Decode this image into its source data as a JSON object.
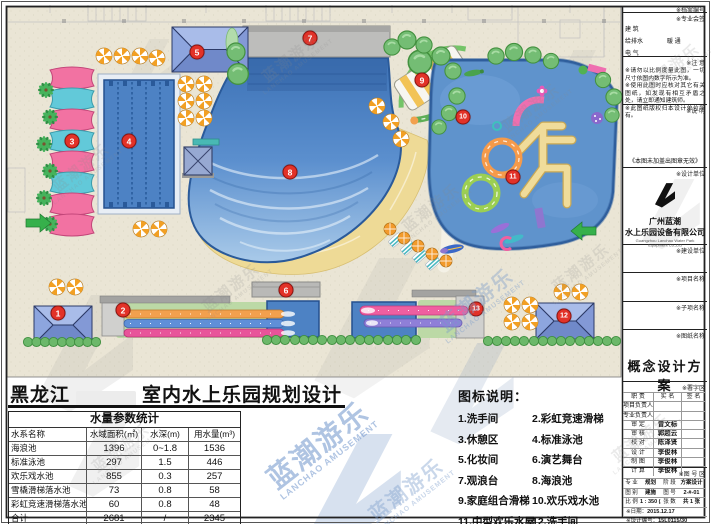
{
  "sheet": {
    "region": "黑龙江",
    "title": "室内水上乐园规划设计"
  },
  "watermark": {
    "cn": "蓝潮游乐",
    "en": "LANCHAO AMUSEMENT"
  },
  "plan": {
    "markers": [
      "1",
      "2",
      "3",
      "4",
      "5",
      "6",
      "7",
      "8",
      "9",
      "10",
      "11",
      "12",
      "13"
    ]
  },
  "water_table": {
    "title": "水量参数统计",
    "headers": [
      "水系名称",
      "水域面积(㎡)",
      "水深(m)",
      "用水量(m³)"
    ],
    "rows": [
      {
        "name": "海浪池",
        "area": "1396",
        "depth": "0~1.8",
        "volume": "1536"
      },
      {
        "name": "标准泳池",
        "area": "297",
        "depth": "1.5",
        "volume": "446"
      },
      {
        "name": "欢乐戏水池",
        "area": "855",
        "depth": "0.3",
        "volume": "257"
      },
      {
        "name": "雪橇滑梯落水池",
        "area": "73",
        "depth": "0.8",
        "volume": "58"
      },
      {
        "name": "彩虹竞速滑梯落水池",
        "area": "60",
        "depth": "0.8",
        "volume": "48"
      },
      {
        "name": "合计",
        "area": "2681",
        "depth": "/",
        "volume": "2345"
      }
    ]
  },
  "legend": {
    "title": "图标说明：",
    "items": [
      "1.洗手间",
      "2.彩虹竞速滑梯",
      "3.休憩区",
      "4.标准泳池",
      "5.化妆间",
      "6.演艺舞台",
      "7.观浪台",
      "8.海浪池",
      "9.家庭组合滑梯",
      "10.欢乐戏水池",
      "11.中型欢乐水屋",
      "12.洗手间",
      "13.雪橇炮筒滑梯"
    ]
  },
  "titleblock": {
    "archive_label": "※档案编号",
    "countersign_label": "※专业会签",
    "disciplines": [
      "建  筑",
      "结  构",
      "给排水",
      "暖  通",
      "电  气"
    ],
    "notice_label": "※注  意",
    "notes": [
      "※请勿以比例度量此图，一切尺寸依图内数字所示为准。",
      "※使用此图时应核对其它有关图纸，如发现有相互矛盾之处，请立即通知建筑师。",
      "※此图纸版权归本设计单位所有。"
    ],
    "remark_label": "※说  明",
    "stamp_note": "《本图未加盖出图章无效》",
    "design_unit_label": "※设计单位",
    "company_cn1": "广州蓝潮",
    "company_cn2": "水上乐园设备有限公司",
    "company_en": "Guangzhou Lanchao Water Park Equipment Co.,Ltd",
    "build_unit_label": "※建设单位",
    "project_label": "※项目名称",
    "subitem_label": "※子项名称",
    "drawing_label": "※图纸名称",
    "drawing_name": "概念设计方案",
    "sign_area_label": "※署字区",
    "sign_headers": [
      "职  责",
      "实  名",
      "签  名"
    ],
    "sign_rows": [
      {
        "role": "项目负责人",
        "name": ""
      },
      {
        "role": "专业负责人",
        "name": ""
      },
      {
        "role": "审  定",
        "name": "曾文标"
      },
      {
        "role": "审  核",
        "name": "郭超云"
      },
      {
        "role": "校  对",
        "name": "陈泽贤"
      },
      {
        "role": "设  计",
        "name": "李俊林"
      },
      {
        "role": "制  图",
        "name": "李俊林"
      },
      {
        "role": "计  算",
        "name": "李俊林"
      }
    ],
    "fig_area_label": "※图 号 区",
    "spec_label": "专 业",
    "spec_value": "规划",
    "stage_label": "阶 段",
    "stage_value": "方案设计",
    "type_label": "图 别",
    "type_value": "建施",
    "no_label": "图 号",
    "no_value": "2-#-01",
    "scale_label": "比 例",
    "scale_value": "1 : 350 (A3)",
    "sheets_label": "张 数",
    "sheets_value": "共 1 张",
    "date_label": "※日期：",
    "date_value": "2015.12.17",
    "designno_label": "※设计编号：",
    "designno_value": "15L0115/30"
  }
}
